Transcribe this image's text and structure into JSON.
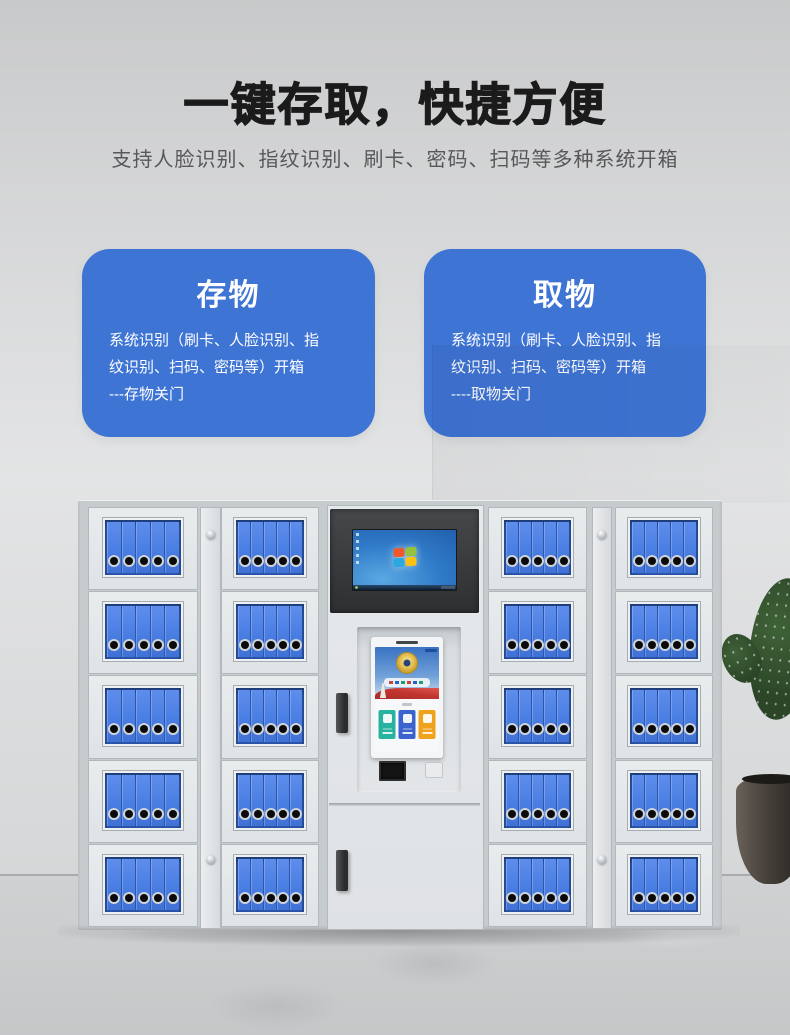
{
  "header": {
    "title": "一键存取，快捷方便",
    "subtitle": "支持人脸识别、指纹识别、刷卡、密码、扫码等多种系统开箱"
  },
  "feature_cards": [
    {
      "title": "存物",
      "lines": [
        "系统识别（刷卡、人脸识别、指",
        "纹识别、扫码、密码等）开箱",
        "---存物关门"
      ]
    },
    {
      "title": "取物",
      "lines": [
        "系统识别（刷卡、人脸识别、指",
        "纹识别、扫码、密码等）开箱",
        "----取物关门"
      ]
    }
  ],
  "locker": {
    "locker_columns": 4,
    "rows_per_column": 5,
    "binders_per_door": 5,
    "kiosk_monitor": "windows-7-desktop",
    "touchscreen_tiles": 3
  },
  "colors": {
    "title_text": "#1b1b1b",
    "subtitle_text": "#58585a",
    "card_blue": "#3e74d4",
    "binder_blue": "#4a7ee2",
    "binder_gap": "#2d57ac",
    "monitor_panel": "#46484b",
    "wallpaper_blue": "#2f7ac8",
    "ribbon_red": "#c23530",
    "tile_teal": "#27b3a0",
    "tile_blue": "#3b63cd",
    "tile_orange": "#efa31c"
  }
}
